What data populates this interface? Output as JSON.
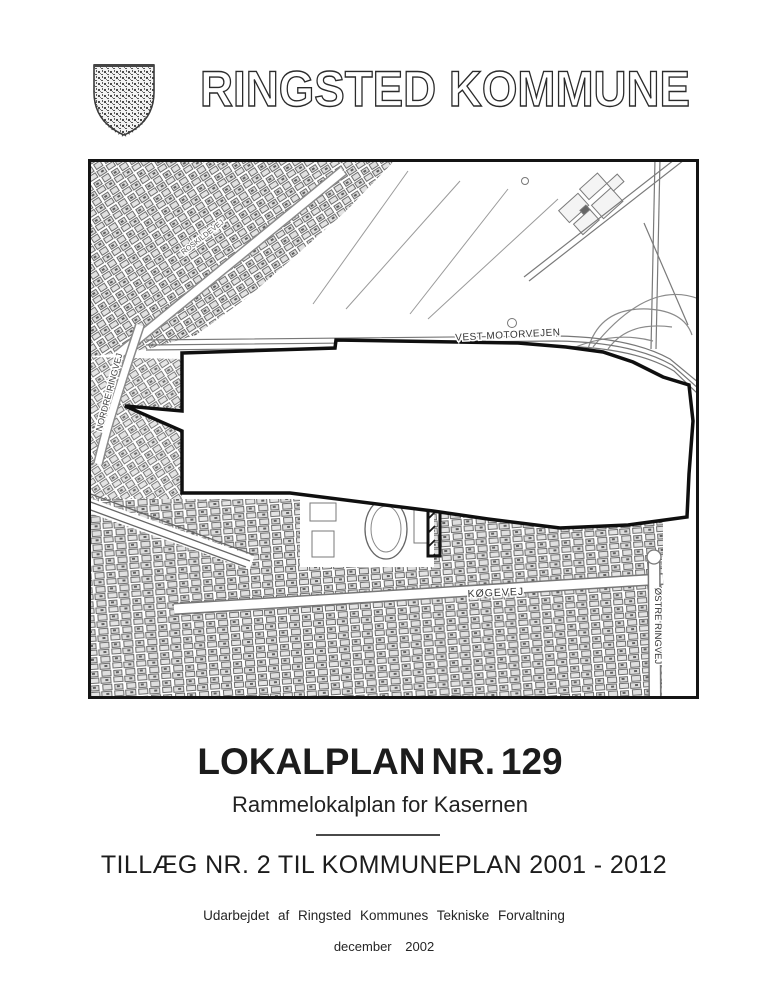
{
  "header": {
    "municipality_name": "RINGSTED KOMMUNE",
    "coat_of_arms_icon": "ringsted-shield"
  },
  "map": {
    "labels": {
      "vest_motorvejen": "VEST MOTORVEJEN",
      "nordre_ringvej": "NORDRE RINGVEJ",
      "roskildevej": "ROSKILDEVEJ",
      "koegevej": "KØGEVEJ",
      "oestre_ringvej": "ØSTRE RINGVEJ"
    }
  },
  "title_block": {
    "main_title": "LOKALPLAN NR. 129",
    "subtitle": "Rammelokalplan for Kasernen",
    "supplement_line": "TILLÆG NR. 2 TIL KOMMUNEPLAN 2001 - 2012"
  },
  "footer": {
    "prepared_by": "Udarbejdet af Ringsted Kommunes Tekniske Forvaltning",
    "date": "december  2002"
  },
  "colors": {
    "ink": "#1f1f1f",
    "map_line": "#777777",
    "boundary": "#111111",
    "paper": "#ffffff"
  }
}
